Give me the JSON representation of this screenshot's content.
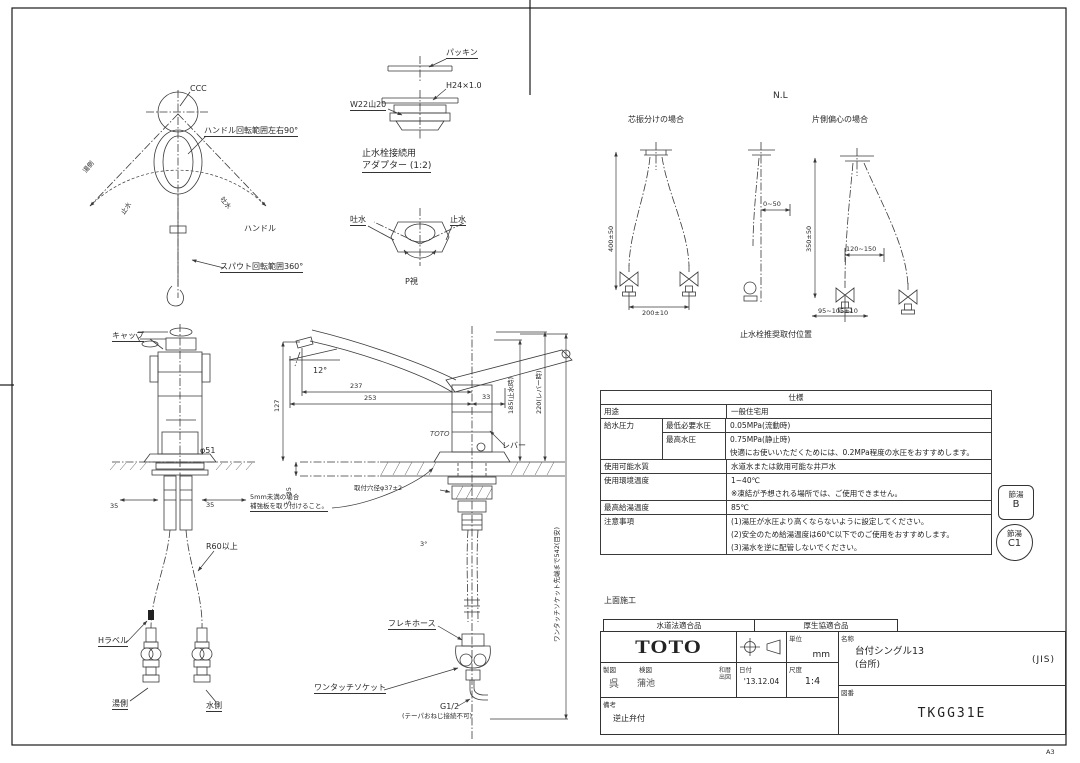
{
  "page": {
    "marker": "A3"
  },
  "top_view": {
    "ccc": "CCC",
    "handle_range": "ハンドル回転範囲左右90°",
    "handle": "ハンドル",
    "spout_range": "スパウト回転範囲360°",
    "hot_rot": "湯側",
    "stop_rot": "止水",
    "open_rot": "吐水"
  },
  "adapter": {
    "packing": "パッキン",
    "thread_top": "H24×1.0",
    "thread_side": "W22山20",
    "title_line1": "止水栓接続用",
    "title_line2": "アダプター (1:2)",
    "open_label": "吐水",
    "close_label": "止水",
    "view_label": "P視"
  },
  "install": {
    "ref": "N.L",
    "case_split": "芯振分けの場合",
    "case_offset": "片側偏心の場合",
    "dim_h_left": "400±50",
    "dim_pitch": "200±10",
    "dim_offset": "0~50",
    "dim_h_right": "350±50",
    "dim_span": "120~150",
    "dim_pitch_right": "95~105±10",
    "caption": "止水栓推奨取付位置"
  },
  "front_view": {
    "cap": "キャップ",
    "dia": "φ51",
    "dim_l": "35",
    "dim_r": "35",
    "r60": "R60以上",
    "h_label": "Hラベル",
    "hot": "湯側",
    "cold": "水側"
  },
  "side_view": {
    "angle": "12°",
    "tilt": "3°",
    "d237": "237",
    "d253": "253",
    "d33": "33",
    "d127": "127",
    "brand": "TOTO",
    "lever": "レバー",
    "note1": "5mm未満の場合",
    "note2": "補強板を取り付けること。",
    "hole": "取付穴径φ37±2",
    "thickness": "5~35",
    "h_stop": "185(止水時)",
    "h_lever": "220(レバー時)",
    "socket_reach": "ワンタッチソケット先端まで542(目安)",
    "flex": "フレキホース",
    "socket": "ワンタッチソケット",
    "g": "G1/2",
    "g_note": "(テーパおねじ接続不可)"
  },
  "spec": {
    "title": "仕様",
    "use_label": "用途",
    "use_value": "一般住宅用",
    "pressure_label": "給水圧力",
    "min_label": "最低必要水圧",
    "min_value": "0.05MPa(流動時)",
    "max_label": "最高水圧",
    "max_value": "0.75MPa(静止時)",
    "pressure_note": "快適にお使いいただくためには、0.2MPa程度の水圧をおすすめします。",
    "quality_label": "使用可能水質",
    "quality_value": "水道水または飲用可能な井戸水",
    "env_label": "使用環境温度",
    "env_value": "1~40℃",
    "env_note": "※凍結が予想される場所では、ご使用できません。",
    "hot_label": "最高給湯温度",
    "hot_value": "85℃",
    "caution_label": "注意事項",
    "caution1": "(1)湯圧が水圧より高くならないように設定してください。",
    "caution2": "(2)安全のため給湯温度は60℃以下でのご使用をおすすめします。",
    "caution3": "(3)湯水を逆に配管しないでください。"
  },
  "badges": {
    "eco_b_label": "節湯",
    "eco_b_value": "B",
    "eco_c_label": "節湯",
    "eco_c_value": "C1"
  },
  "title_block": {
    "mount_note": "上面施工",
    "cert1": "水道法適合品",
    "cert2": "厚生協適合品",
    "brand": "TOTO",
    "unit_label": "単位",
    "unit_value": "mm",
    "draft_label": "製図",
    "check_label": "検図",
    "draft_stamp": "呉",
    "check_stamp": "蒲池",
    "era_note": "和暦出図",
    "date_label": "日付",
    "date_value": "'13.12.04",
    "scale_label": "尺度",
    "scale_value": "1:4",
    "name_label": "名称",
    "name_value1": "台付シングル13",
    "name_value2": "(台所)",
    "name_tag": "(JIS)",
    "number_label": "図番",
    "number_value": "TKGG31E",
    "remarks_label": "備考",
    "remarks_value": "逆止弁付"
  }
}
